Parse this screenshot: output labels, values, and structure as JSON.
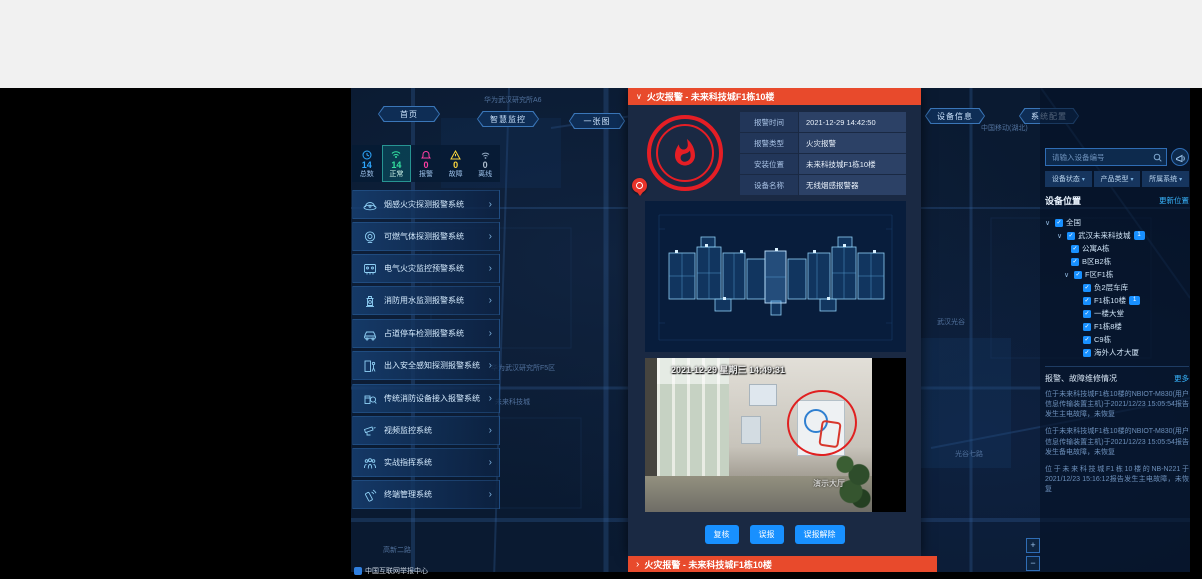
{
  "page": {
    "status_text": "中国互联网举报中心"
  },
  "top_nav": {
    "home": "首页",
    "monitor": "智慧监控",
    "one_map": "一张图",
    "device_info": "设备信息",
    "system_config": "系统配置"
  },
  "map_labels": {
    "l1": "华为武汉研究所A6",
    "l2": "中国移动(湖北)",
    "l3": "华为武汉研究所F5区",
    "l4": "未来科技城",
    "l5": "武汉光谷",
    "l6": "光谷七路",
    "l7": "高新二路"
  },
  "stats": {
    "items": [
      {
        "label": "总数",
        "value": "14"
      },
      {
        "label": "正常",
        "value": "14"
      },
      {
        "label": "报警",
        "value": "0"
      },
      {
        "label": "故障",
        "value": "0"
      },
      {
        "label": "离线",
        "value": "0"
      }
    ]
  },
  "systems": {
    "items": [
      {
        "label": "烟感火灾探测报警系统"
      },
      {
        "label": "可燃气体探测报警系统"
      },
      {
        "label": "电气火灾监控预警系统"
      },
      {
        "label": "消防用水监测报警系统"
      },
      {
        "label": "占道停车检测报警系统"
      },
      {
        "label": "出入安全感知探测报警系统"
      },
      {
        "label": "传统消防设备接入报警系统"
      },
      {
        "label": "视频监控系统"
      },
      {
        "label": "实战指挥系统"
      },
      {
        "label": "终端管理系统"
      }
    ]
  },
  "modal": {
    "title": "火灾报警 - 未来科技城F1栋10楼",
    "fields": [
      {
        "label": "报警时间",
        "value": "2021-12-29 14:42:50"
      },
      {
        "label": "报警类型",
        "value": "火灾报警"
      },
      {
        "label": "安装位置",
        "value": "未来科技城F1栋10楼"
      },
      {
        "label": "设备名称",
        "value": "无线烟感报警器"
      }
    ],
    "camera_timestamp": "2021-12-29 星期三 14:49:31",
    "camera_watermark": "演示大厅",
    "buttons": {
      "recheck": "复核",
      "false_alarm": "误报",
      "dismiss": "误报解除"
    }
  },
  "collapsed_alarm": {
    "title": "火灾报警 - 未来科技城F1栋10楼"
  },
  "right_panel": {
    "search_placeholder": "请输入设备编号",
    "filters": [
      {
        "label": "设备状态"
      },
      {
        "label": "产品类型"
      },
      {
        "label": "所属系统"
      }
    ],
    "location": {
      "title": "设备位置",
      "action": "更新位置"
    },
    "tree": {
      "root": "全国",
      "park": "武汉未来科技城",
      "park_badge": "1",
      "n1": "公寓A栋",
      "n2": "B区B2栋",
      "n3": "F区F1栋",
      "c1": "负2层车库",
      "c2": "F1栋10楼",
      "c2_badge": "1",
      "c3": "一楼大堂",
      "c4": "F1栋8楼",
      "c5": "C9栋",
      "c6": "海外人才大厦"
    },
    "alarm_info": {
      "title": "报警、故障维修情况",
      "action": "更多",
      "messages": [
        {
          "text": "位于未来科技城F1栋10楼的NBIOT-M830(用户信息传输装置主机)于2021/12/23 15:05:54报告发生主电故障，未恢复"
        },
        {
          "text": "位于未来科技城F1栋10楼的NBIOT-M830(用户信息传输装置主机)于2021/12/23 15:05:54报告发生备电故障，未恢复"
        },
        {
          "text": "位于未来科技城F1栋10楼的NB-N221于2021/12/23 15:16:12报告发生主电故障，未恢复"
        }
      ]
    }
  },
  "map_controls": {
    "zoom_in": "+",
    "zoom_out": "−"
  }
}
